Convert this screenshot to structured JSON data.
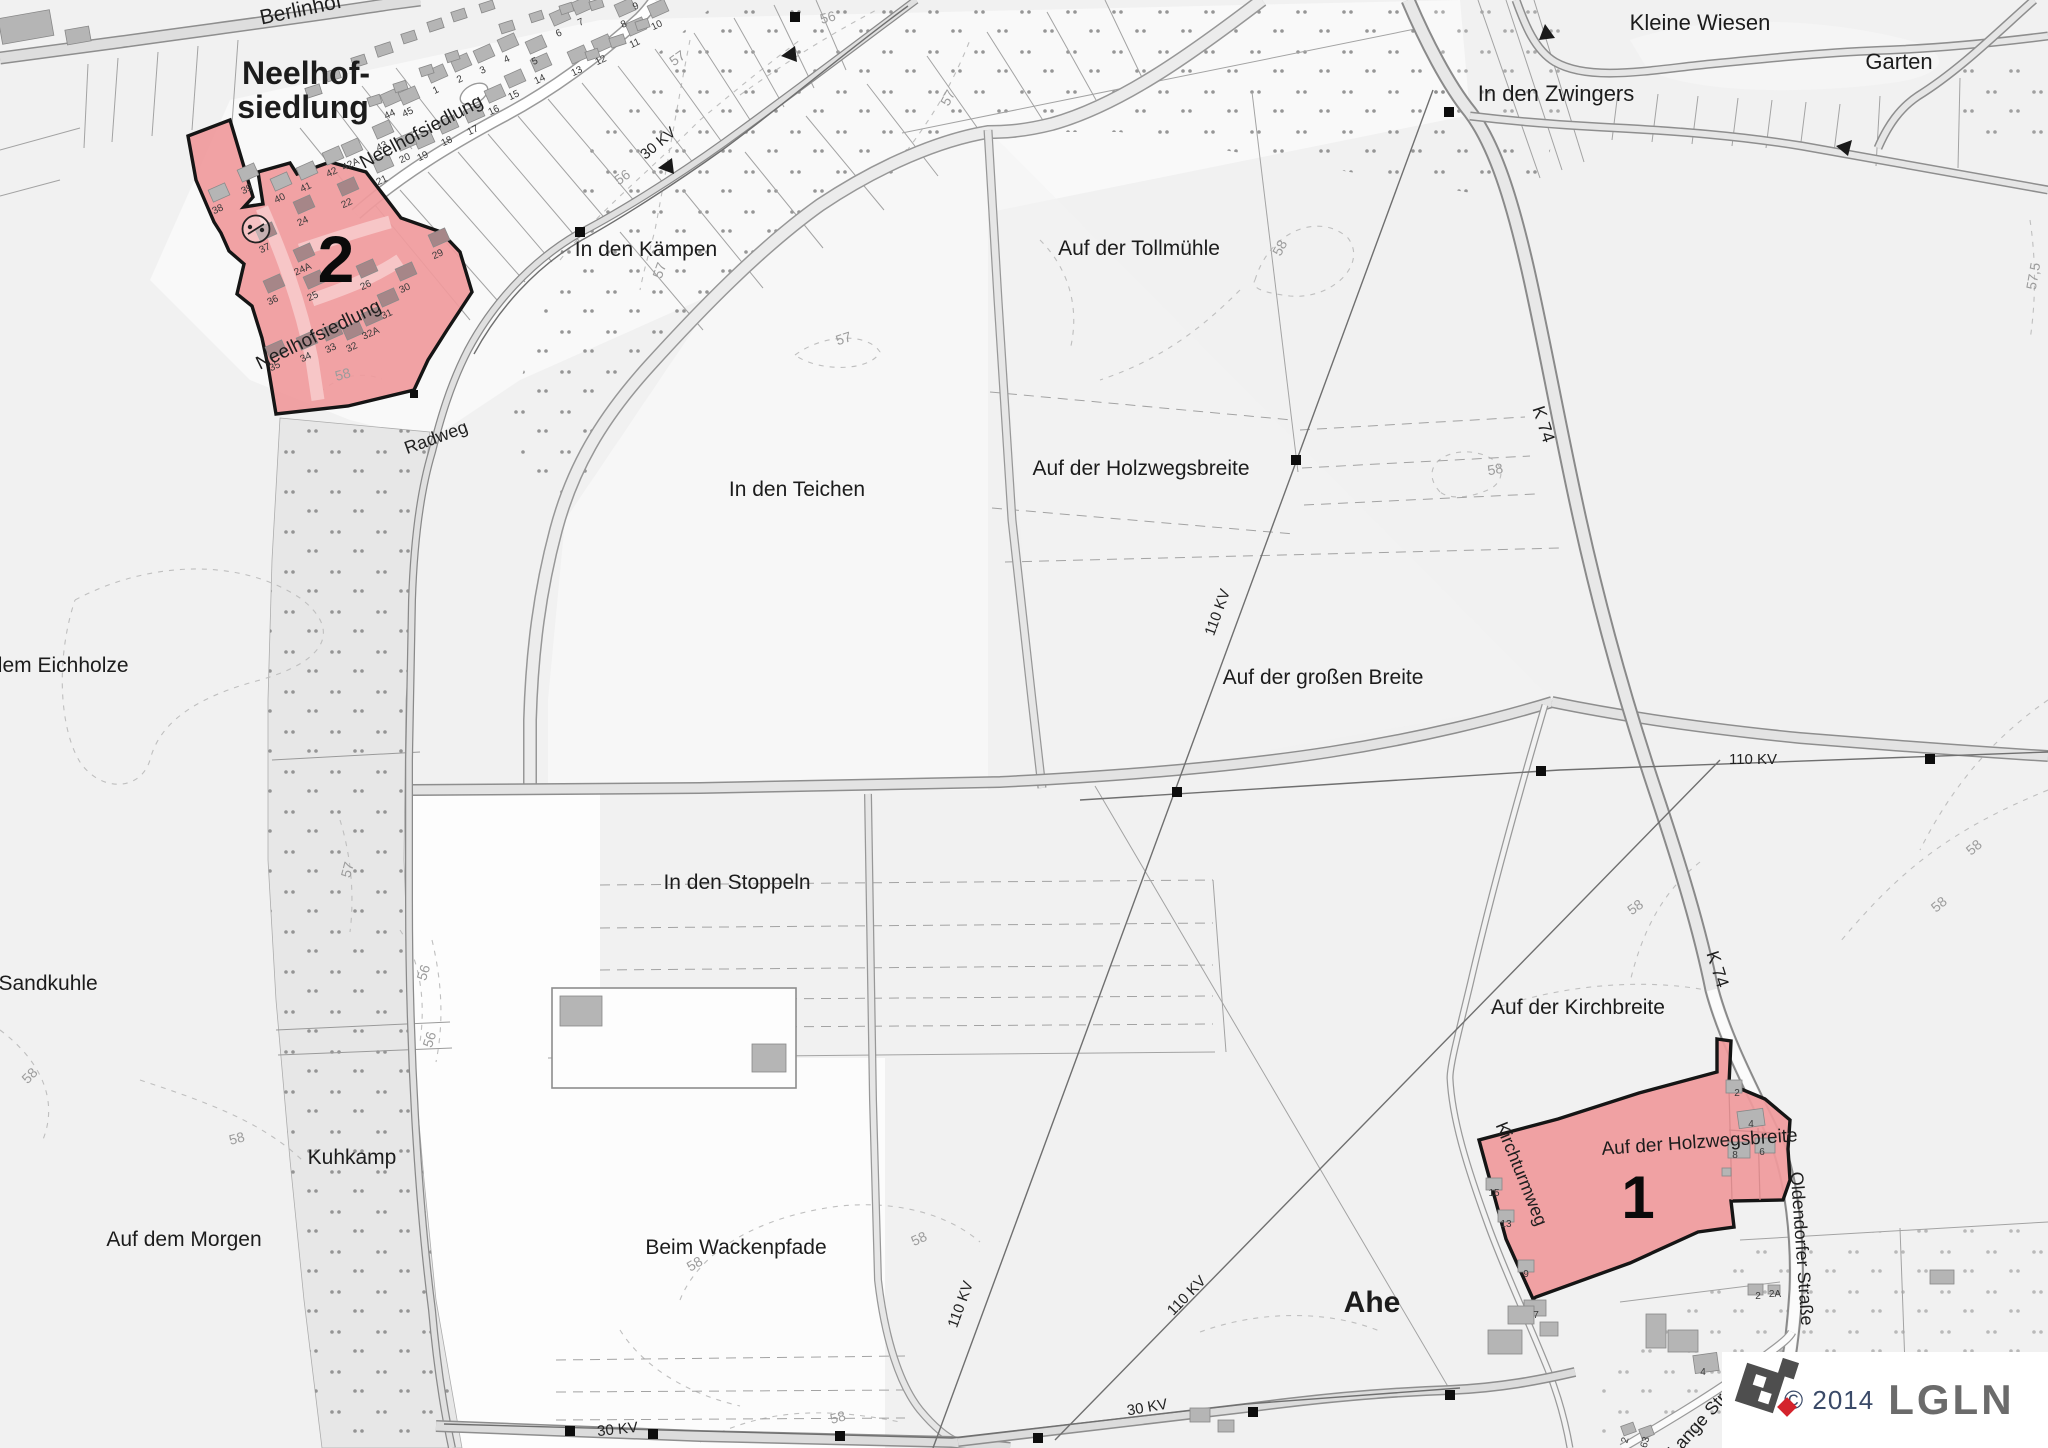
{
  "map": {
    "legend": {
      "copyright": "© 2014",
      "brand": "LGLN"
    },
    "colors": {
      "zone_fill": "#f09a9c",
      "zone_border": "#151515",
      "brand_red": "#d4232c"
    },
    "zone_numbers": [
      {
        "text": "2",
        "x": 336,
        "y": 282,
        "size": 66
      },
      {
        "text": "1",
        "x": 1638,
        "y": 1218,
        "size": 60
      }
    ],
    "field_labels": [
      {
        "text": "Neelhof-",
        "x": 306,
        "y": 84,
        "size": 32,
        "bold": true
      },
      {
        "text": "siedlung",
        "x": 303,
        "y": 118,
        "size": 32,
        "bold": true
      },
      {
        "text": "Kleine Wiesen",
        "x": 1700,
        "y": 30,
        "size": 22
      },
      {
        "text": "Garten",
        "x": 1899,
        "y": 69,
        "size": 22
      },
      {
        "text": "In den Zwingers",
        "x": 1556,
        "y": 101,
        "size": 22
      },
      {
        "text": "In den Kämpen",
        "x": 646,
        "y": 256,
        "size": 21
      },
      {
        "text": "Auf der Tollmühle",
        "x": 1139,
        "y": 255,
        "size": 21
      },
      {
        "text": "Auf der Holzwegsbreite",
        "x": 1141,
        "y": 475,
        "size": 21
      },
      {
        "text": "In den Teichen",
        "x": 797,
        "y": 496,
        "size": 21
      },
      {
        "text": "Auf der großen Breite",
        "x": 1323,
        "y": 684,
        "size": 21
      },
      {
        "text": "In den Stoppeln",
        "x": 737,
        "y": 889,
        "size": 21
      },
      {
        "text": "In dem Eichholze",
        "x": 48,
        "y": 672,
        "size": 21
      },
      {
        "text": "der Sandkuhle",
        "x": 30,
        "y": 990,
        "size": 21
      },
      {
        "text": "Kuhkamp",
        "x": 352,
        "y": 1164,
        "size": 21
      },
      {
        "text": "Auf dem Morgen",
        "x": 184,
        "y": 1246,
        "size": 21
      },
      {
        "text": "Beim Wackenpfade",
        "x": 736,
        "y": 1254,
        "size": 21
      },
      {
        "text": "Auf der Kirchbreite",
        "x": 1578,
        "y": 1014,
        "size": 21
      },
      {
        "text": "Auf der Holzwegsbreite",
        "x": 1700,
        "y": 1148,
        "size": 19,
        "rot": -4
      },
      {
        "text": "Ahe",
        "x": 1372,
        "y": 1312,
        "size": 30,
        "bold": true
      }
    ],
    "street_labels": [
      {
        "text": "Berlinhof",
        "x": 302,
        "y": 16,
        "size": 21,
        "rot": -12
      },
      {
        "text": "Neelhofsiedlung",
        "x": 424,
        "y": 137,
        "size": 19,
        "rot": -28
      },
      {
        "text": "Neelhofsiedlung",
        "x": 321,
        "y": 340,
        "size": 19,
        "rot": -26
      },
      {
        "text": "Radweg",
        "x": 438,
        "y": 443,
        "size": 18,
        "rot": -20
      },
      {
        "text": "Kirchturmweg",
        "x": 1516,
        "y": 1176,
        "size": 18,
        "rot": 68
      },
      {
        "text": "Oldendorfer Straße",
        "x": 1796,
        "y": 1249,
        "size": 18,
        "rot": 86
      },
      {
        "text": "Lange Straße",
        "x": 1712,
        "y": 1417,
        "size": 18,
        "rot": -48
      },
      {
        "text": "K 74",
        "x": 1538,
        "y": 426,
        "size": 18,
        "rot": 72
      },
      {
        "text": "K 74",
        "x": 1712,
        "y": 971,
        "size": 18,
        "rot": 72
      }
    ],
    "power_labels": [
      {
        "text": "30 KV",
        "x": 661,
        "y": 147,
        "size": 15,
        "rot": -40
      },
      {
        "text": "110 KV",
        "x": 1222,
        "y": 614,
        "size": 15,
        "rot": -70
      },
      {
        "text": "110 KV",
        "x": 1753,
        "y": 764,
        "size": 15
      },
      {
        "text": "110 KV",
        "x": 965,
        "y": 1306,
        "size": 15,
        "rot": -70
      },
      {
        "text": "110 KV",
        "x": 1190,
        "y": 1299,
        "size": 15,
        "rot": -46
      },
      {
        "text": "30 KV",
        "x": 618,
        "y": 1434,
        "size": 15,
        "rot": -6
      },
      {
        "text": "30 KV",
        "x": 1148,
        "y": 1412,
        "size": 15,
        "rot": -10
      }
    ],
    "contour_labels": [
      {
        "text": "56",
        "x": 829,
        "y": 22,
        "rot": -15
      },
      {
        "text": "57",
        "x": 680,
        "y": 62,
        "rot": -35
      },
      {
        "text": "57",
        "x": 952,
        "y": 100,
        "rot": -62
      },
      {
        "text": "56",
        "x": 625,
        "y": 181,
        "rot": -35
      },
      {
        "text": "57",
        "x": 664,
        "y": 272,
        "rot": -70
      },
      {
        "text": "58",
        "x": 1284,
        "y": 250,
        "rot": -62
      },
      {
        "text": "57,5",
        "x": 2038,
        "y": 277,
        "rot": -80
      },
      {
        "text": "57",
        "x": 845,
        "y": 343,
        "rot": -18
      },
      {
        "text": "58",
        "x": 344,
        "y": 379,
        "rot": -15
      },
      {
        "text": "58",
        "x": 1496,
        "y": 474,
        "rot": -10
      },
      {
        "text": "58",
        "x": 33,
        "y": 1079,
        "rot": -45
      },
      {
        "text": "57",
        "x": 352,
        "y": 871,
        "rot": -75
      },
      {
        "text": "56",
        "x": 428,
        "y": 974,
        "rot": -72
      },
      {
        "text": "56",
        "x": 434,
        "y": 1041,
        "rot": -72
      },
      {
        "text": "58",
        "x": 238,
        "y": 1143,
        "rot": -15
      },
      {
        "text": "58",
        "x": 1638,
        "y": 911,
        "rot": -35
      },
      {
        "text": "58",
        "x": 1977,
        "y": 851,
        "rot": -40
      },
      {
        "text": "58",
        "x": 1942,
        "y": 908,
        "rot": -40
      },
      {
        "text": "58",
        "x": 921,
        "y": 1243,
        "rot": -25
      },
      {
        "text": "58",
        "x": 697,
        "y": 1268,
        "rot": -30
      },
      {
        "text": "58",
        "x": 839,
        "y": 1422,
        "rot": -15
      }
    ],
    "house_numbers": [
      {
        "text": "1",
        "x": 437,
        "y": 93,
        "rot": -25
      },
      {
        "text": "2",
        "x": 461,
        "y": 82,
        "rot": -25
      },
      {
        "text": "3",
        "x": 484,
        "y": 73,
        "rot": -25
      },
      {
        "text": "4",
        "x": 508,
        "y": 62,
        "rot": -25
      },
      {
        "text": "5",
        "x": 536,
        "y": 64,
        "rot": -25
      },
      {
        "text": "6",
        "x": 560,
        "y": 36,
        "rot": -25
      },
      {
        "text": "7",
        "x": 582,
        "y": 25,
        "rot": -25
      },
      {
        "text": "8",
        "x": 625,
        "y": 27,
        "rot": -25
      },
      {
        "text": "9",
        "x": 637,
        "y": 9,
        "rot": -25
      },
      {
        "text": "10",
        "x": 658,
        "y": 28,
        "rot": -25
      },
      {
        "text": "11",
        "x": 636,
        "y": 46,
        "rot": -25
      },
      {
        "text": "12",
        "x": 602,
        "y": 63,
        "rot": -25
      },
      {
        "text": "13",
        "x": 578,
        "y": 74,
        "rot": -25
      },
      {
        "text": "14",
        "x": 541,
        "y": 82,
        "rot": -25
      },
      {
        "text": "15",
        "x": 515,
        "y": 98,
        "rot": -25
      },
      {
        "text": "16",
        "x": 495,
        "y": 113,
        "rot": -25
      },
      {
        "text": "17",
        "x": 474,
        "y": 133,
        "rot": -25
      },
      {
        "text": "18",
        "x": 448,
        "y": 144,
        "rot": -25
      },
      {
        "text": "19",
        "x": 424,
        "y": 159,
        "rot": -25
      },
      {
        "text": "20",
        "x": 406,
        "y": 161,
        "rot": -25
      },
      {
        "text": "21",
        "x": 383,
        "y": 183,
        "rot": -25
      },
      {
        "text": "38",
        "x": 219,
        "y": 212,
        "rot": -25
      },
      {
        "text": "39",
        "x": 248,
        "y": 192,
        "rot": -25
      },
      {
        "text": "40",
        "x": 281,
        "y": 201,
        "rot": -25
      },
      {
        "text": "41",
        "x": 307,
        "y": 190,
        "rot": -25
      },
      {
        "text": "42",
        "x": 333,
        "y": 175,
        "rot": -25
      },
      {
        "text": "42A",
        "x": 352,
        "y": 167,
        "rot": -25
      },
      {
        "text": "43",
        "x": 383,
        "y": 149,
        "rot": -25
      },
      {
        "text": "44",
        "x": 391,
        "y": 117,
        "rot": -25
      },
      {
        "text": "45",
        "x": 409,
        "y": 115,
        "rot": -25
      },
      {
        "text": "22",
        "x": 348,
        "y": 206,
        "rot": -25
      },
      {
        "text": "24",
        "x": 304,
        "y": 224,
        "rot": -25
      },
      {
        "text": "24A",
        "x": 304,
        "y": 272,
        "rot": -25
      },
      {
        "text": "25",
        "x": 314,
        "y": 299,
        "rot": -25
      },
      {
        "text": "26",
        "x": 367,
        "y": 288,
        "rot": -25
      },
      {
        "text": "29",
        "x": 439,
        "y": 257,
        "rot": -25
      },
      {
        "text": "30",
        "x": 406,
        "y": 291,
        "rot": -25
      },
      {
        "text": "31",
        "x": 388,
        "y": 317,
        "rot": -25
      },
      {
        "text": "32A",
        "x": 372,
        "y": 336,
        "rot": -25
      },
      {
        "text": "32",
        "x": 353,
        "y": 350,
        "rot": -25
      },
      {
        "text": "33",
        "x": 332,
        "y": 351,
        "rot": -25
      },
      {
        "text": "34",
        "x": 307,
        "y": 360,
        "rot": -25
      },
      {
        "text": "35",
        "x": 276,
        "y": 369,
        "rot": -25
      },
      {
        "text": "36",
        "x": 274,
        "y": 303,
        "rot": -25
      },
      {
        "text": "37",
        "x": 266,
        "y": 251,
        "rot": -25
      },
      {
        "text": "2",
        "x": 1737,
        "y": 1096
      },
      {
        "text": "4",
        "x": 1751,
        "y": 1127
      },
      {
        "text": "8",
        "x": 1735,
        "y": 1158
      },
      {
        "text": "6",
        "x": 1762,
        "y": 1155
      },
      {
        "text": "15",
        "x": 1494,
        "y": 1196
      },
      {
        "text": "13",
        "x": 1506,
        "y": 1227
      },
      {
        "text": "9",
        "x": 1526,
        "y": 1277
      },
      {
        "text": "7",
        "x": 1536,
        "y": 1318
      },
      {
        "text": "2",
        "x": 1758,
        "y": 1299
      },
      {
        "text": "2A",
        "x": 1775,
        "y": 1297
      },
      {
        "text": "4",
        "x": 1703,
        "y": 1375
      },
      {
        "text": "2",
        "x": 1628,
        "y": 1441,
        "rot": -75
      },
      {
        "text": "63",
        "x": 1648,
        "y": 1443,
        "rot": -75
      }
    ]
  }
}
